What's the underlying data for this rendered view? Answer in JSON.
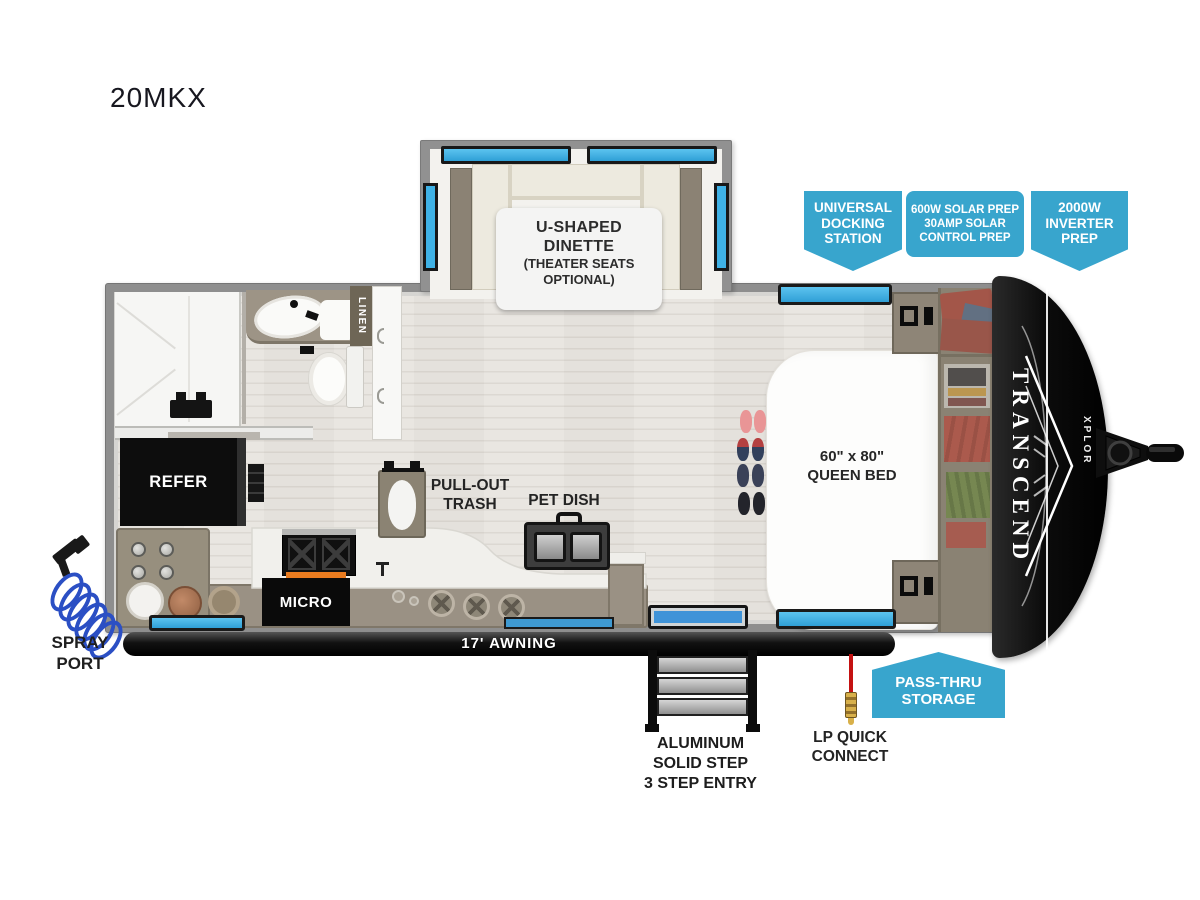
{
  "title": "20MKX",
  "callouts": {
    "docking": [
      "UNIVERSAL",
      "DOCKING",
      "STATION"
    ],
    "solar": [
      "600W SOLAR PREP",
      "30AMP SOLAR",
      "CONTROL PREP"
    ],
    "inverter": [
      "2000W",
      "INVERTER",
      "PREP"
    ],
    "passthru": [
      "PASS-THRU",
      "STORAGE"
    ]
  },
  "labels": {
    "dinette": [
      "U-SHAPED",
      "DINETTE",
      "(THEATER SEATS",
      "OPTIONAL)"
    ],
    "linen": "LINEN",
    "refer": "REFER",
    "micro": "MICRO",
    "trash": [
      "PULL-OUT",
      "TRASH"
    ],
    "pet": "PET DISH",
    "bed": [
      "60\" x 80\"",
      "QUEEN BED"
    ],
    "awning": "17' AWNING",
    "steps": [
      "ALUMINUM",
      "SOLID STEP",
      "3 STEP ENTRY"
    ],
    "lp": [
      "LP QUICK",
      "CONNECT"
    ],
    "spray": [
      "SPRAY",
      "PORT"
    ],
    "brand": "TRANSCEND",
    "brand_sub": "XPLOR"
  },
  "colors": {
    "callout_blue": "#38a5cd",
    "window_blue": "#3fb2e6",
    "wall_gray": "#8e8e8e",
    "floor_wood": "#e9e6e1",
    "counter_taupe": "#9a9184",
    "appliance_black": "#0d0d0d",
    "accent_orange": "#e97b1f",
    "lp_red": "#c41212",
    "coil_blue": "#2b4fc4"
  }
}
